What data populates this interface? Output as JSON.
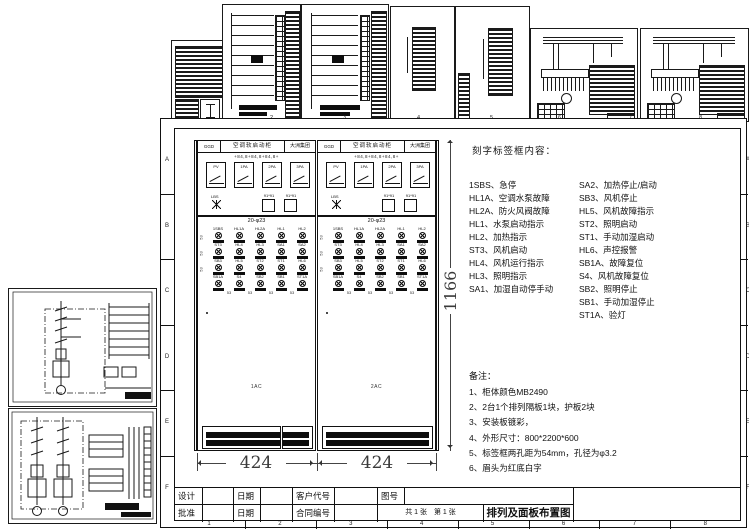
{
  "sheet_frame": {
    "row_labels": [
      "A",
      "B",
      "C",
      "D",
      "E",
      "F"
    ],
    "col_labels": [
      "1",
      "2",
      "3",
      "4",
      "5",
      "6",
      "7",
      "8"
    ],
    "top_col_labels": [
      "2",
      "3",
      "4",
      "5",
      "6",
      "7",
      "8"
    ]
  },
  "cabinets": {
    "header": {
      "code": "GGD",
      "title": "空调软启动柜",
      "company": "大洲集团"
    },
    "meter_dims": "+84,8+84,8+84,8+",
    "meters": [
      "PV",
      "1PA",
      "2PA",
      "3PA"
    ],
    "switch_label": "LBS",
    "window_label": "91*91",
    "grid_title": "20-φ23",
    "device_pitch": "53",
    "devices": [
      [
        "1SBS",
        "HL1A",
        "HL2A",
        "HL1",
        "HL2"
      ],
      [
        "ST3",
        "HL4",
        "HL3",
        "SA1",
        "SA2"
      ],
      [
        "SB3",
        "HL5",
        "ST2",
        "ST1",
        "HL6"
      ],
      [
        "SB1A",
        "S4",
        "SB2",
        "SB1",
        "ST1A"
      ]
    ],
    "units": [
      {
        "id": "1AC"
      },
      {
        "id": "2AC"
      }
    ]
  },
  "dims": {
    "cabinet_width": "424",
    "total_height": "1166"
  },
  "labels_panel": {
    "title": "刻字标签框内容：",
    "left": [
      "1SBS、急停",
      "HL1A、空调水泵故障",
      "HL2A、防火风阀故障",
      "HL1、水泵启动指示",
      "HL2、加热指示",
      "ST3、风机启动",
      "HL4、风机运行指示",
      "HL3、照明指示",
      "SA1、加湿自动停手动"
    ],
    "right": [
      "SA2、加热停止/启动",
      "SB3、风机停止",
      "HL5、风机故障指示",
      "ST2、照明启动",
      "ST1、手动加湿启动",
      "HL6、声控报警",
      "SB1A、故障复位",
      "S4、风机故障复位",
      "SB2、照明停止",
      "SB1、手动加湿停止",
      "ST1A、验灯"
    ]
  },
  "notes": {
    "title": "备注：",
    "items": [
      "1、柜体颜色MB2490",
      "2、2台1个排列隔板1块，护板2块",
      "3、安装板镀彩，",
      "4、外形尺寸：800*2200*600",
      "5、标签框两孔距为54mm，孔径为φ3.2",
      "6、眉头为红底白字"
    ]
  },
  "title_block": {
    "design_label": "设计",
    "approve_label": "批准",
    "date_label": "日期",
    "customer_label": "客户代号",
    "contract_label": "合同编号",
    "drawing_no_label": "图号",
    "sheet_info": "共 1 张　第 1 张",
    "drawing_title": "排列及面板布置图"
  },
  "colors": {
    "line": "#1a1a1a",
    "paper": "#ffffff",
    "dim_text": "#3a3a3a"
  }
}
